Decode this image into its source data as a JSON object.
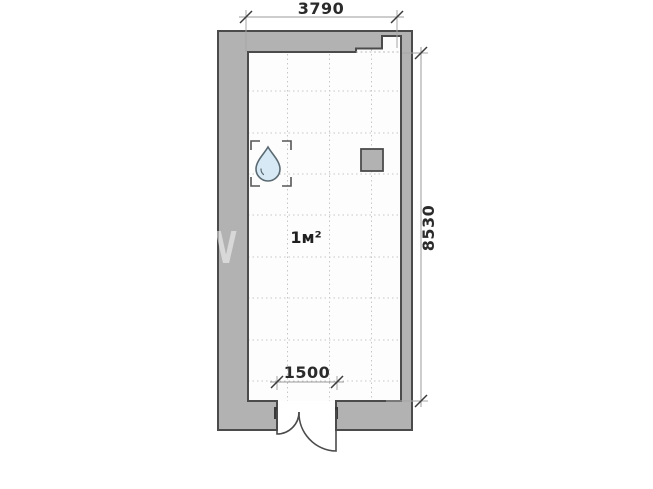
{
  "floor_plan": {
    "room": {
      "area_label": "1м²"
    },
    "dimensions": {
      "top_label": "3790",
      "right_label": "8530",
      "door_label": "1500"
    },
    "watermark_letter": "V",
    "colors": {
      "wall_fill": "#b2b2b2",
      "wall_outline": "#4b4b4b",
      "interior_fill": "#fdfdfd",
      "grid_dot": "#c6c6c6",
      "dimension_line": "#9b9b9b",
      "dimension_tick": "#3c3c3c",
      "dimension_text": "#2b2b2b",
      "door_stroke": "#4b4b4b",
      "drop_fill": "#d7e9f4",
      "drop_outline": "#5a6a73",
      "shaft_fill": "#b2b2b2",
      "watermark": "#ffffff"
    }
  }
}
